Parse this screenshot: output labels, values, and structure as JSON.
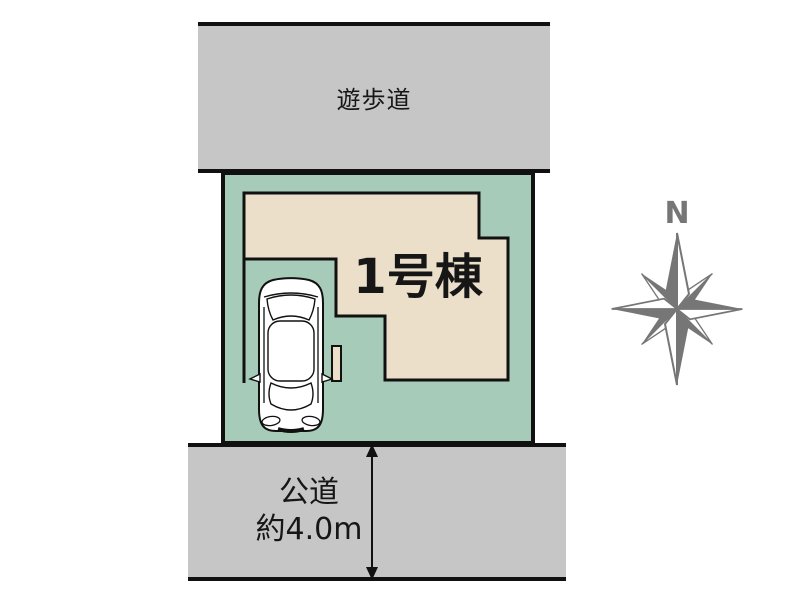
{
  "plan": {
    "walkway_label": "遊歩道",
    "building_label": "1号棟",
    "road_label_line1": "公道",
    "road_label_line2": "約4.0m",
    "compass_label": "N"
  },
  "icons": {
    "compass": "compass-rose",
    "vehicle": "car-top-view",
    "dimension": "double-headed-arrow"
  },
  "colors": {
    "lot_green": "#a6cbb8",
    "house_beige": "#ebdfca",
    "road_gray": "#c6c6c6",
    "outline_black": "#111111",
    "compass_gray": "#767676",
    "text_black": "#161616"
  }
}
